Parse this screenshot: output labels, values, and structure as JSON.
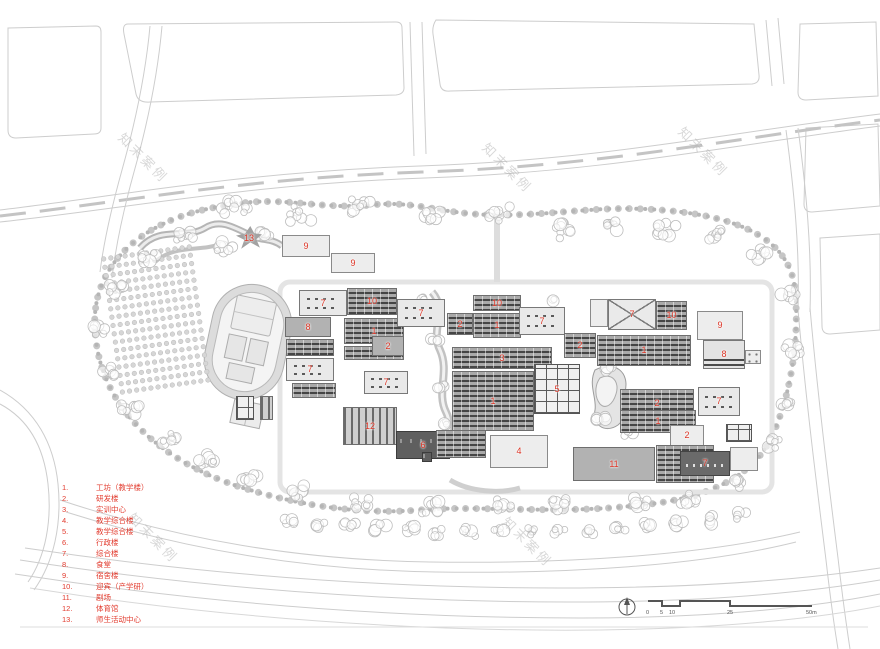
{
  "sheet": {
    "background": "#ffffff"
  },
  "watermark": {
    "text": "知末案例"
  },
  "colors": {
    "label_red": "#dd3526",
    "legend_red": "#e23b2e",
    "road": "#cdcdcd",
    "tree": "#bdbdbd",
    "building_gray": "#a9a9a9",
    "building_dark": "#454545",
    "building_light": "#ededed"
  },
  "legend": {
    "items": [
      {
        "num": "1.",
        "label": "工坊（教学楼）"
      },
      {
        "num": "2.",
        "label": "研发楼"
      },
      {
        "num": "3.",
        "label": "实训中心"
      },
      {
        "num": "4.",
        "label": "教学综合楼"
      },
      {
        "num": "5.",
        "label": "教学综合楼"
      },
      {
        "num": "6.",
        "label": "行政楼"
      },
      {
        "num": "7.",
        "label": "综合楼"
      },
      {
        "num": "8.",
        "label": "食堂"
      },
      {
        "num": "9.",
        "label": "宿舍楼"
      },
      {
        "num": "10.",
        "label": "迎宾（产学研）"
      },
      {
        "num": "11.",
        "label": "剧场"
      },
      {
        "num": "12.",
        "label": "体育馆"
      },
      {
        "num": "13.",
        "label": "师生活动中心"
      }
    ]
  },
  "scalebar": {
    "ticks": [
      "0",
      "5",
      "10",
      "25",
      "50m"
    ]
  },
  "compass": {
    "icon": "north-arrow-icon"
  },
  "buildings": [
    {
      "n": "13",
      "x": 236,
      "y": 226,
      "w": 26,
      "h": 24,
      "t": "star"
    },
    {
      "n": "9",
      "x": 282,
      "y": 235,
      "w": 48,
      "h": 22,
      "t": "light"
    },
    {
      "n": "9",
      "x": 331,
      "y": 253,
      "w": 44,
      "h": 20,
      "t": "light"
    },
    {
      "n": "7",
      "x": 299,
      "y": 290,
      "w": 48,
      "h": 26,
      "t": "court"
    },
    {
      "n": "8",
      "x": 285,
      "y": 317,
      "w": 46,
      "h": 20,
      "t": "gray"
    },
    {
      "n": "",
      "x": 286,
      "y": 339,
      "w": 48,
      "h": 17,
      "t": "bars"
    },
    {
      "n": "7",
      "x": 286,
      "y": 358,
      "w": 48,
      "h": 23,
      "t": "court"
    },
    {
      "n": "",
      "x": 292,
      "y": 383,
      "w": 44,
      "h": 15,
      "t": "bars"
    },
    {
      "n": "",
      "x": 236,
      "y": 396,
      "w": 18,
      "h": 24,
      "t": "grid"
    },
    {
      "n": "",
      "x": 260,
      "y": 396,
      "w": 13,
      "h": 24,
      "t": "vstripes"
    },
    {
      "n": "10",
      "x": 347,
      "y": 288,
      "w": 50,
      "h": 27,
      "t": "bars"
    },
    {
      "n": "1",
      "x": 344,
      "y": 318,
      "w": 60,
      "h": 26,
      "t": "bars"
    },
    {
      "n": "",
      "x": 344,
      "y": 346,
      "w": 60,
      "h": 14,
      "t": "bars"
    },
    {
      "n": "2",
      "x": 372,
      "y": 336,
      "w": 32,
      "h": 20,
      "t": "gray"
    },
    {
      "n": "7",
      "x": 364,
      "y": 371,
      "w": 44,
      "h": 23,
      "t": "court"
    },
    {
      "n": "12",
      "x": 343,
      "y": 407,
      "w": 54,
      "h": 38,
      "t": "vstripes"
    },
    {
      "n": "6",
      "x": 396,
      "y": 431,
      "w": 54,
      "h": 28,
      "t": "dark"
    },
    {
      "n": "",
      "x": 422,
      "y": 452,
      "w": 10,
      "h": 10,
      "t": "dark"
    },
    {
      "n": "7",
      "x": 397,
      "y": 299,
      "w": 48,
      "h": 28,
      "t": "court"
    },
    {
      "n": "10",
      "x": 473,
      "y": 295,
      "w": 48,
      "h": 16,
      "t": "bars"
    },
    {
      "n": "1",
      "x": 473,
      "y": 313,
      "w": 48,
      "h": 25,
      "t": "bars"
    },
    {
      "n": "2",
      "x": 447,
      "y": 313,
      "w": 26,
      "h": 22,
      "t": "bars"
    },
    {
      "n": "7",
      "x": 519,
      "y": 307,
      "w": 46,
      "h": 28,
      "t": "court"
    },
    {
      "n": "2",
      "x": 564,
      "y": 333,
      "w": 32,
      "h": 25,
      "t": "bars"
    },
    {
      "n": "3",
      "x": 452,
      "y": 347,
      "w": 100,
      "h": 22,
      "t": "bars"
    },
    {
      "n": "1",
      "x": 452,
      "y": 371,
      "w": 82,
      "h": 60,
      "t": "bars"
    },
    {
      "n": "5",
      "x": 534,
      "y": 364,
      "w": 46,
      "h": 50,
      "t": "grid"
    },
    {
      "n": "",
      "x": 436,
      "y": 430,
      "w": 50,
      "h": 28,
      "t": "bars"
    },
    {
      "n": "4",
      "x": 490,
      "y": 435,
      "w": 58,
      "h": 33,
      "t": "light"
    },
    {
      "n": "",
      "x": 590,
      "y": 299,
      "w": 18,
      "h": 28,
      "t": "light"
    },
    {
      "n": "7",
      "x": 608,
      "y": 299,
      "w": 48,
      "h": 31,
      "t": "courtx"
    },
    {
      "n": "10",
      "x": 656,
      "y": 301,
      "w": 31,
      "h": 29,
      "t": "bars"
    },
    {
      "n": "9",
      "x": 697,
      "y": 311,
      "w": 46,
      "h": 29,
      "t": "light"
    },
    {
      "n": "1",
      "x": 597,
      "y": 335,
      "w": 94,
      "h": 31,
      "t": "bars"
    },
    {
      "n": "8",
      "x": 703,
      "y": 340,
      "w": 42,
      "h": 29,
      "t": "mixed"
    },
    {
      "n": "",
      "x": 745,
      "y": 350,
      "w": 16,
      "h": 14,
      "t": "dots"
    },
    {
      "n": "2",
      "x": 620,
      "y": 389,
      "w": 74,
      "h": 29,
      "t": "bars"
    },
    {
      "n": "7",
      "x": 698,
      "y": 387,
      "w": 42,
      "h": 29,
      "t": "court"
    },
    {
      "n": "1",
      "x": 620,
      "y": 410,
      "w": 76,
      "h": 23,
      "t": "bars"
    },
    {
      "n": "2",
      "x": 670,
      "y": 425,
      "w": 34,
      "h": 21,
      "t": "light"
    },
    {
      "n": "",
      "x": 726,
      "y": 424,
      "w": 26,
      "h": 18,
      "t": "grid"
    },
    {
      "n": "",
      "x": 730,
      "y": 447,
      "w": 28,
      "h": 24,
      "t": "light"
    },
    {
      "n": "11",
      "x": 573,
      "y": 447,
      "w": 82,
      "h": 34,
      "t": "gray"
    },
    {
      "n": "",
      "x": 656,
      "y": 445,
      "w": 58,
      "h": 38,
      "t": "bars"
    },
    {
      "n": "7",
      "x": 680,
      "y": 451,
      "w": 50,
      "h": 25,
      "t": "darkcourt"
    }
  ]
}
